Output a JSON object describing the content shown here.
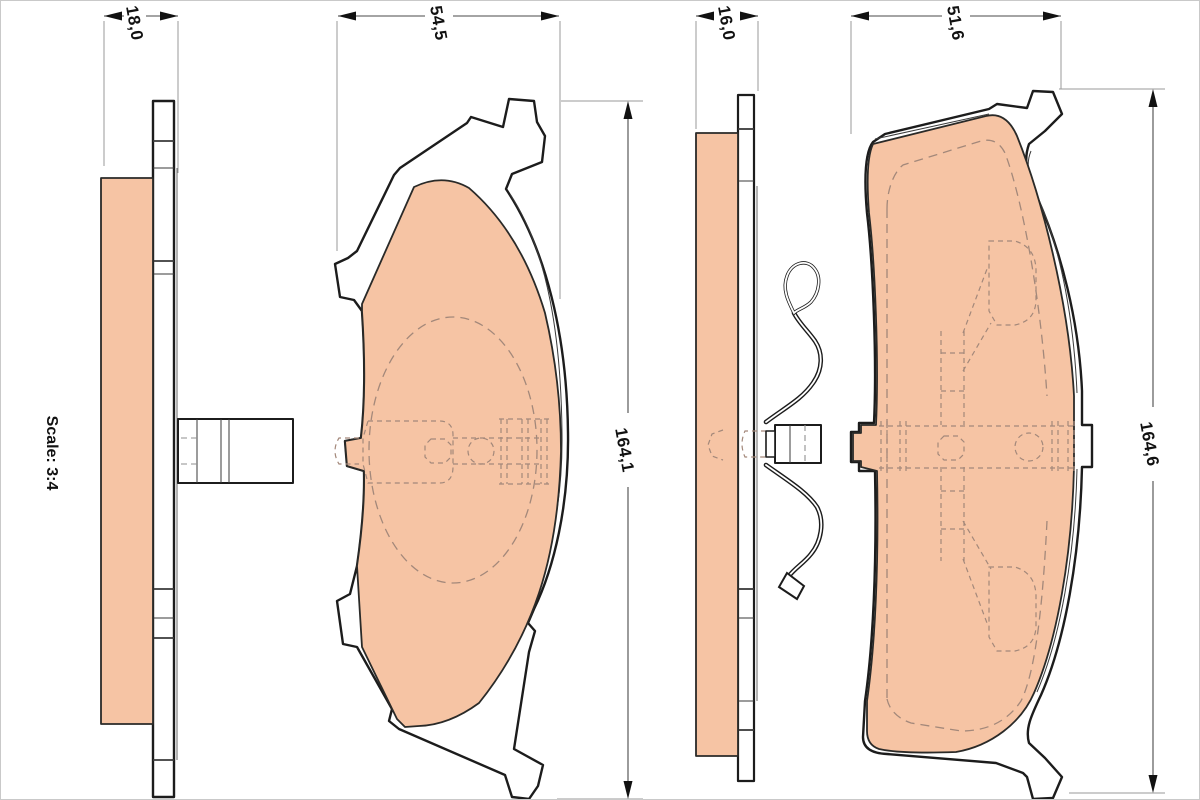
{
  "drawing": {
    "title_hidden": "",
    "scale_label": "Scale: 3:4",
    "colors": {
      "background": "#ffffff",
      "frame": "#c9c9c9",
      "outline": "#1c1c1c",
      "friction": "#f6c4a4",
      "friction_edge": "#2a2a28",
      "dash_on_pad": "#a3887a",
      "dash_gray": "#8f8f8f",
      "dim_line": "#4a4a4a",
      "witness": "#9a9a9a",
      "text": "#111111"
    },
    "pad_a": {
      "dim_thickness": "18,0",
      "dim_width": "54,5",
      "dim_height": "164,1"
    },
    "pad_b": {
      "dim_thickness": "16,0",
      "dim_width": "51,6",
      "dim_height": "164,6"
    }
  }
}
